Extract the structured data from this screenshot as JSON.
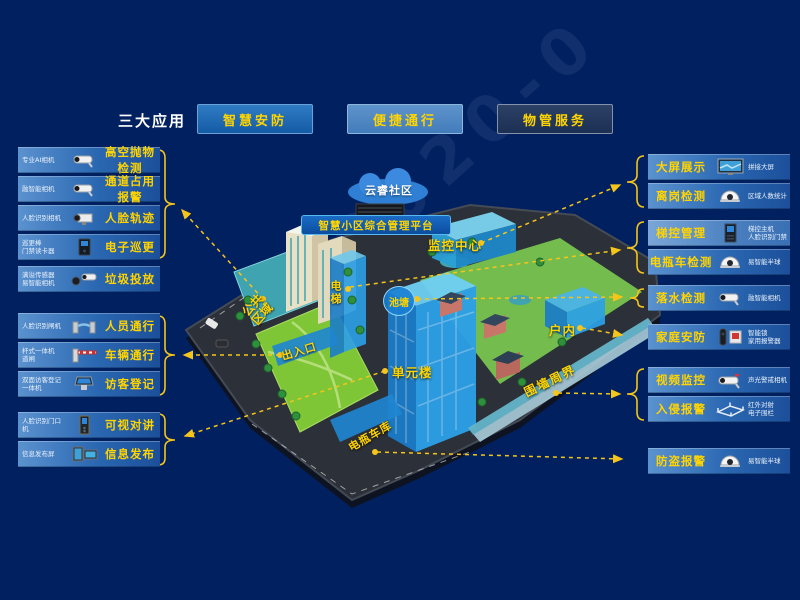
{
  "header": {
    "title": "三大应用",
    "apps": [
      {
        "label": "智慧安防"
      },
      {
        "label": "便捷通行"
      },
      {
        "label": "物管服务"
      }
    ]
  },
  "left": {
    "g1": {
      "items": [
        {
          "device": "专业AI相机",
          "label": "高空抛物检测",
          "icon": "bullet-camera"
        },
        {
          "device": "融智能相机",
          "label": "通道占用报警",
          "icon": "bullet-camera"
        },
        {
          "device": "人脸识别相机",
          "label": "人脸轨迹",
          "icon": "box-camera"
        },
        {
          "device": "巡更棒\n门禁读卡器",
          "label": "电子巡更",
          "icon": "access-reader"
        }
      ]
    },
    "g2": {
      "items": [
        {
          "device": "满溢传感器\n易智能相机",
          "label": "垃圾投放",
          "icon": "sensor-camera"
        }
      ]
    },
    "g3": {
      "items": [
        {
          "device": "人脸识别闸机",
          "label": "人员通行",
          "icon": "turnstile"
        },
        {
          "device": "杆式一体机\n道闸",
          "label": "车辆通行",
          "icon": "barrier-gate"
        },
        {
          "device": "双面访客登记\n一体机",
          "label": "访客登记",
          "icon": "visitor-kiosk"
        }
      ]
    },
    "g4": {
      "items": [
        {
          "device": "人脸识别门口\n机",
          "label": "可视对讲",
          "icon": "door-station"
        },
        {
          "device": "信息发布屏",
          "label": "信息发布",
          "icon": "info-screens"
        }
      ]
    }
  },
  "right": {
    "g1": {
      "items": [
        {
          "label": "大屏展示",
          "device": "拼接大屏",
          "icon": "video-wall"
        },
        {
          "label": "离岗检测",
          "device": "区域人数统计",
          "icon": "dome-camera"
        }
      ]
    },
    "g2": {
      "items": [
        {
          "label": "梯控管理",
          "device": "梯控主机\n人脸识别门禁",
          "icon": "elevator-terminal"
        },
        {
          "label": "电瓶车检测",
          "device": "易智能半球",
          "icon": "dome-camera"
        }
      ]
    },
    "g3": {
      "items": [
        {
          "label": "落水检测",
          "device": "融智能相机",
          "icon": "bullet-camera"
        }
      ]
    },
    "g4": {
      "items": [
        {
          "label": "家庭安防",
          "device": "智能锁\n家用报警器",
          "icon": "lock-alarm"
        }
      ]
    },
    "g5": {
      "items": [
        {
          "label": "视频监控",
          "device": "声光警戒相机",
          "icon": "alert-camera"
        },
        {
          "label": "入侵报警",
          "device": "红外对射\n电子围栏",
          "icon": "ir-fence"
        }
      ]
    },
    "g6": {
      "items": [
        {
          "label": "防盗报警",
          "device": "易智能半球",
          "icon": "dome-camera"
        }
      ]
    }
  },
  "map": {
    "cloud": "云睿社区",
    "platform": "智慧小区综合管理平台",
    "monitor_center": "监控中心",
    "elevator": "电梯",
    "pond": "池塘",
    "public_area": "公共\n区域",
    "entrance": "出入口",
    "unit_building": "单元楼",
    "indoor": "户内",
    "perimeter": "围墙周界",
    "bike_garage": "电瓶车库"
  },
  "watermark": "33-2020-0",
  "colors": {
    "background": "#01205f",
    "accent_yellow": "#ffd400",
    "row_blue": "#2b68b2",
    "highlight_blue": "#1f8fd6",
    "arrow_yellow": "#f5c51a"
  }
}
